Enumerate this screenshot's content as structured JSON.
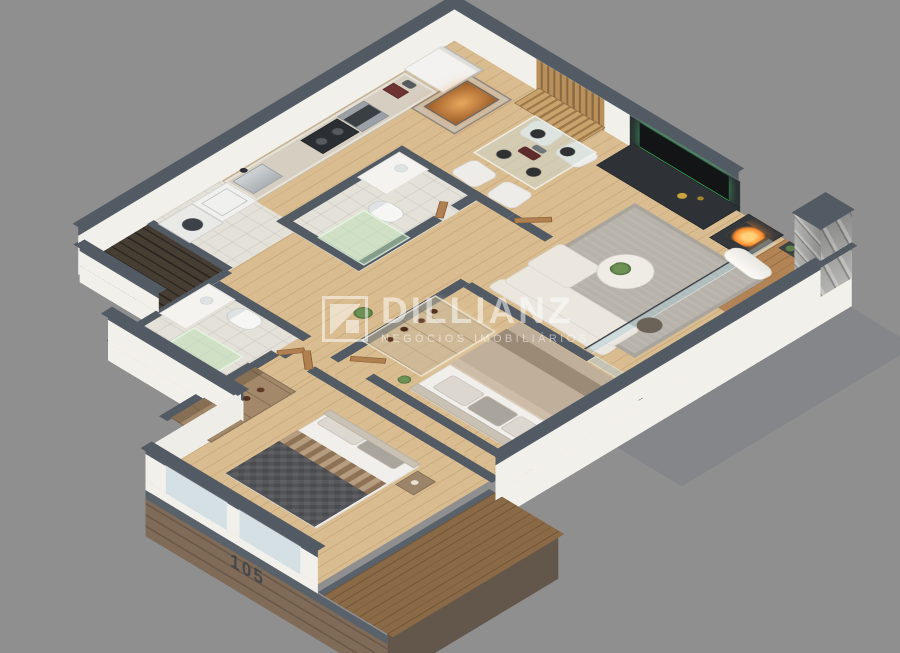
{
  "watermark": {
    "brand": "DILLIANZ",
    "tagline": "NEGÓCIOS IMOBILIÁRIOS",
    "logo_icon": "square-diagonal-mark"
  },
  "unit": {
    "number": "105"
  },
  "palette": {
    "background": "#8f8f8f",
    "wall_top_slate": "#545c66",
    "wall_face_white": "#efede7",
    "wood_floor": "#d9bc8f",
    "balcony_deck": "#b28455",
    "facade_wood": "#7f6b57",
    "tv_glow_green": "#3ecf5e",
    "fire_orange": "#ff9c3d",
    "grill_copper": "#c97f3d",
    "shower_glass_green": "#bae0b2",
    "rug_gray": "#b7b3aa",
    "bed_dark_quilt": "#4a4b4e",
    "bed_taupe": "#c0af9a",
    "stone_pillar": "#b4b4b2"
  },
  "rooms": [
    "service-balcony",
    "laundry",
    "kitchen",
    "dining-room",
    "living-room",
    "balcony",
    "hallway",
    "bathroom-1",
    "bathroom-2",
    "bedroom-2",
    "closet-bedroom-2",
    "master-bedroom",
    "master-closet"
  ]
}
